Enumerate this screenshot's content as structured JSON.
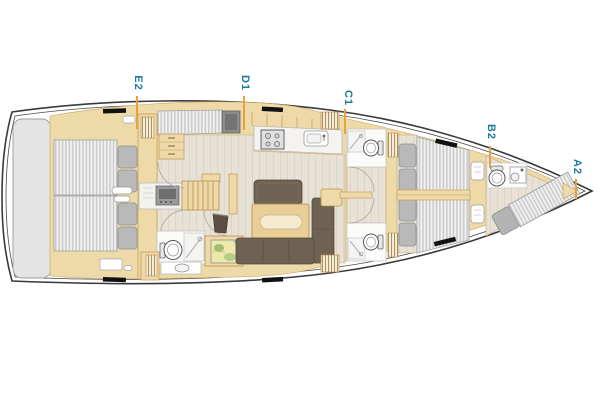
{
  "diagram": {
    "type": "yacht interior layout plan",
    "orientation": "bow-right"
  },
  "zone_labels": [
    {
      "text": "E2",
      "zone": "aft-cabins"
    },
    {
      "text": "D1",
      "zone": "saloon-galley"
    },
    {
      "text": "C1",
      "zone": "midship-heads"
    },
    {
      "text": "B2",
      "zone": "forward-cabins"
    },
    {
      "text": "A2",
      "zone": "forepeak"
    }
  ],
  "colors": {
    "label_teal": "#1b7a9c",
    "marker_orange": "#e7a23e",
    "hull_outline": "#3a3a3a",
    "furniture_tan": "#eedaa9",
    "furniture_border": "#c49552",
    "floor_light": "#e8e2d6",
    "sofa_brown": "#6e6253",
    "mattress_stripe": "#c9c9c9",
    "pillow_gray": "#b9b9b9",
    "platform_gray": "#e4e4e4",
    "hull_window_black": "#111111"
  }
}
